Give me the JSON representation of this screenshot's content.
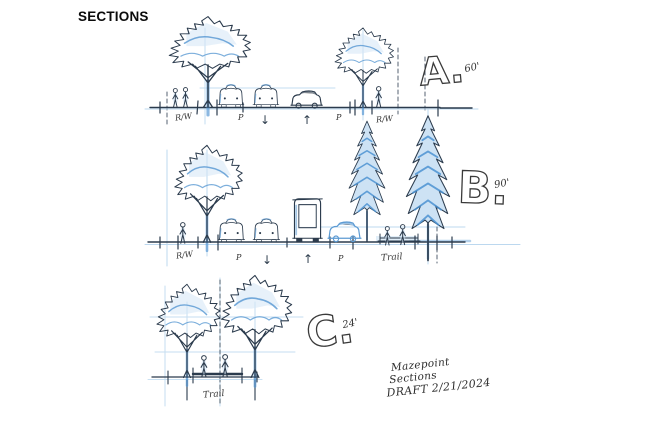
{
  "title": "SECTIONS",
  "colors": {
    "ink": "#2b3b4d",
    "marker_blue": "#4f93d2",
    "marker_light": "#cde2f4",
    "guide_blue": "#bcd8ef",
    "pencil": "#333333",
    "paper": "#ffffff"
  },
  "section_a": {
    "label": "A.",
    "dimension": "60'",
    "rw_left": "R/W",
    "parking_left": "P",
    "lane_down_arrow": "↓",
    "lane_up_arrow": "↑",
    "parking_right": "P",
    "rw_right": "R/W"
  },
  "section_b": {
    "label": "B.",
    "dimension": "90'",
    "rw_left": "R/W",
    "parking_left": "P",
    "lane_down_arrow": "↓",
    "lane_up_arrow": "↑",
    "parking_right": "P",
    "trail": "Trail"
  },
  "section_c": {
    "label": "C.",
    "dimension": "24'",
    "trail": "Trail"
  },
  "notes": {
    "line1": "Mazepoint",
    "line2": "Sections",
    "line3": "DRAFT 2/21/2024"
  }
}
